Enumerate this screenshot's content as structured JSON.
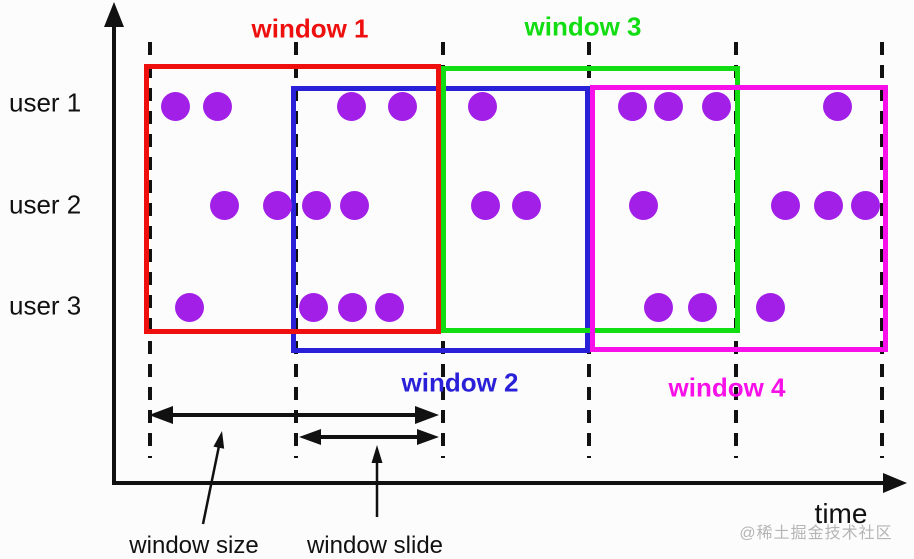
{
  "diagram": {
    "users": [
      {
        "label": "user 1"
      },
      {
        "label": "user 2"
      },
      {
        "label": "user 3"
      }
    ],
    "windows": [
      {
        "id": "window-1",
        "label": "window 1",
        "color": "#ee0f0f"
      },
      {
        "id": "window-2",
        "label": "window 2",
        "color": "#2a20d8"
      },
      {
        "id": "window-3",
        "label": "window 3",
        "color": "#12dd12"
      },
      {
        "id": "window-4",
        "label": "window 4",
        "color": "#f711e8"
      }
    ],
    "annotations": {
      "window_size": "window size",
      "window_slide": "window slide"
    },
    "axis": {
      "time_label": "time"
    },
    "dot_color": "#a21fe8",
    "events": {
      "user1": [
        175,
        217,
        351,
        402,
        482,
        632,
        668,
        716,
        837
      ],
      "user2": [
        224,
        277,
        316,
        354,
        485,
        526,
        643,
        785,
        828,
        865
      ],
      "user3": [
        189,
        313,
        352,
        389,
        658,
        702,
        770
      ]
    }
  },
  "watermark": "@稀土掘金技术社区"
}
